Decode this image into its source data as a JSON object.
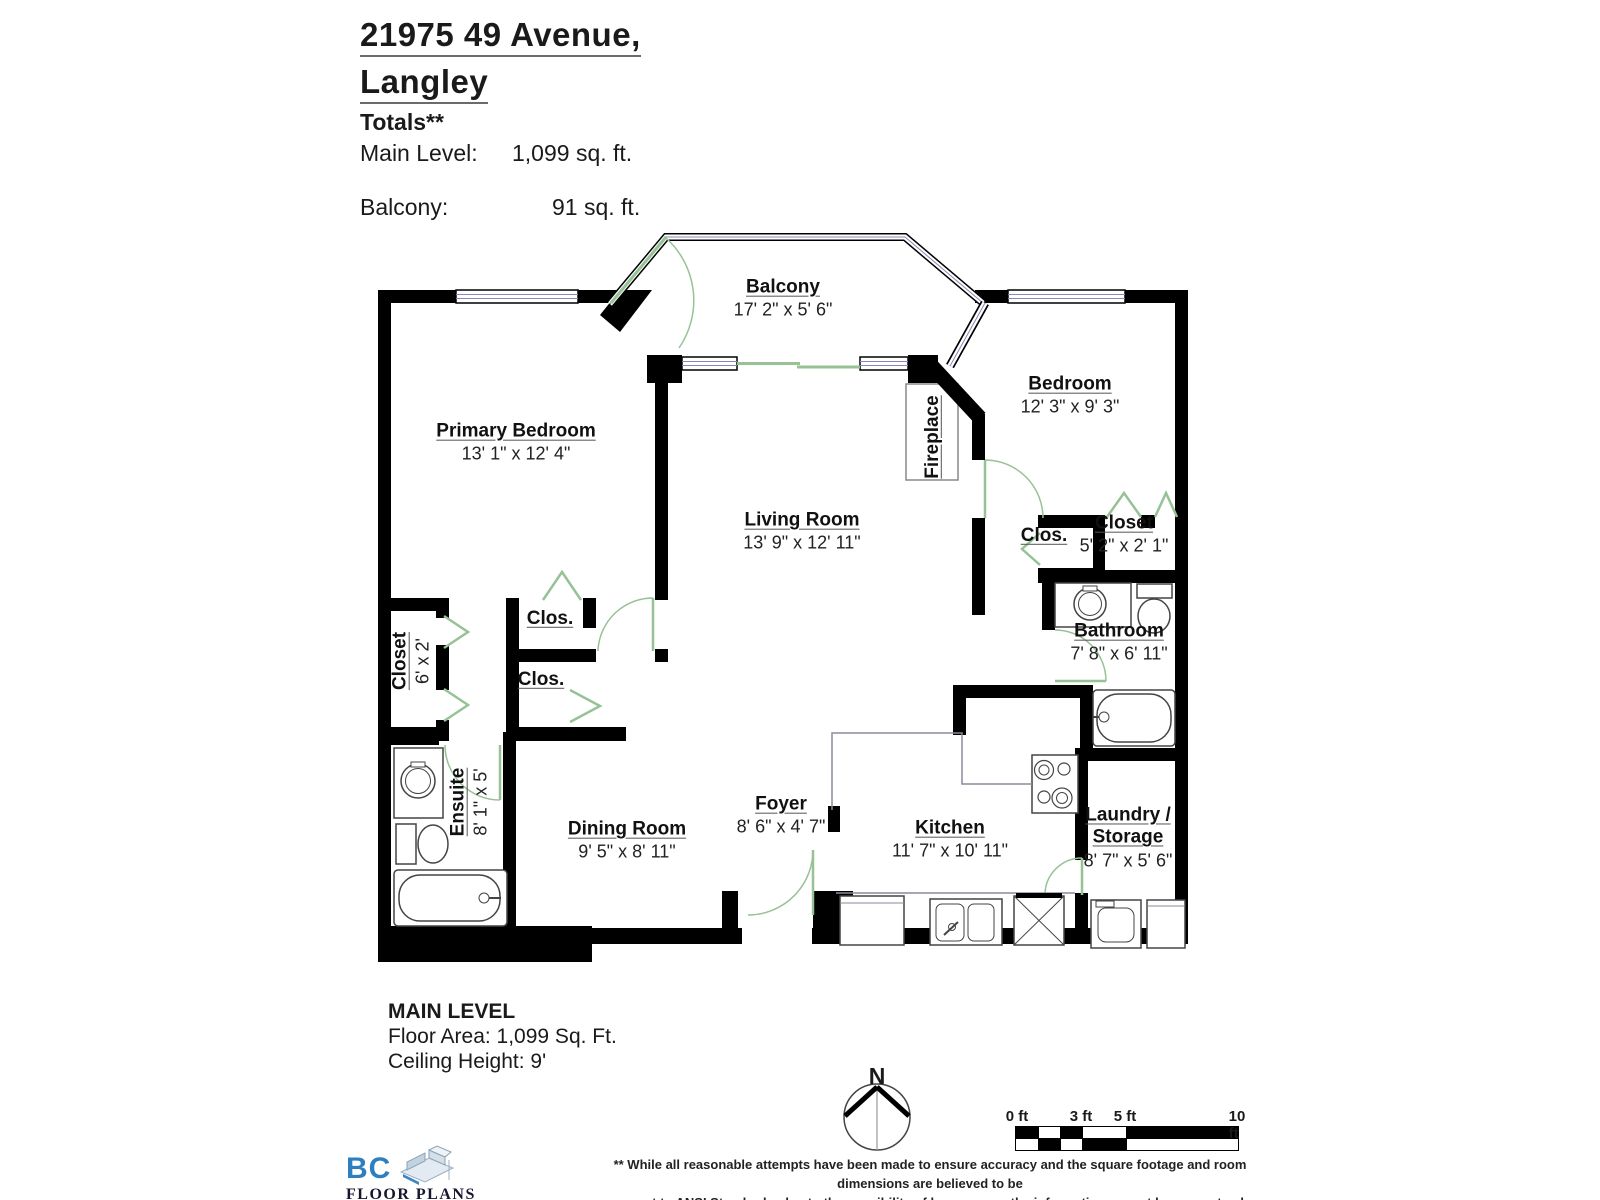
{
  "header": {
    "title_line1": "21975 49 Avenue,",
    "title_line2": "Langley",
    "totals_label": "Totals**",
    "totals": [
      {
        "label": "Main Level:",
        "value": "1,099 sq. ft."
      },
      {
        "label": "Balcony:",
        "value": "91 sq. ft."
      }
    ]
  },
  "rooms": {
    "balcony": {
      "name": "Balcony",
      "dims": "17' 2\" x 5' 6\""
    },
    "primary_bedroom": {
      "name": "Primary Bedroom",
      "dims": "13' 1\" x 12' 4\""
    },
    "bedroom": {
      "name": "Bedroom",
      "dims": "12' 3\" x 9' 3\""
    },
    "living_room": {
      "name": "Living Room",
      "dims": "13' 9\" x 12' 11\""
    },
    "fireplace": {
      "name": "Fireplace"
    },
    "closet_small_1": {
      "name": "Clos."
    },
    "closet_small_2": {
      "name": "Clos."
    },
    "closet_small_3": {
      "name": "Clos."
    },
    "closet_left": {
      "name": "Closet",
      "dims": "6' x 2'"
    },
    "ensuite": {
      "name": "Ensuite",
      "dims": "8' 1\" x 5'"
    },
    "closet_right": {
      "name": "Closet",
      "dims": "5' 2\" x 2' 1\""
    },
    "bathroom": {
      "name": "Bathroom",
      "dims": "7' 8\" x 6' 11\""
    },
    "dining_room": {
      "name": "Dining Room",
      "dims": "9' 5\" x 8' 11\""
    },
    "foyer": {
      "name": "Foyer",
      "dims": "8' 6\" x 4' 7\""
    },
    "kitchen": {
      "name": "Kitchen",
      "dims": "11' 7\" x 10' 11\""
    },
    "laundry": {
      "name_line1": "Laundry /",
      "name_line2": "Storage",
      "dims": "8' 7\" x 5' 6\""
    }
  },
  "footer": {
    "level_name": "MAIN LEVEL",
    "floor_area": "Floor Area: 1,099 Sq. Ft.",
    "ceiling_height": "Ceiling Height: 9'",
    "compass_label": "N",
    "scale": {
      "labels": [
        "0 ft",
        "3 ft",
        "5 ft",
        "10 ft"
      ]
    },
    "logo": {
      "line1": "BC",
      "line2": "FLOOR PLANS"
    },
    "disclaimer_line1": "** While all reasonable attempts have been made to ensure accuracy and the square footage and room dimensions are believed to be",
    "disclaimer_line2": "correct to ANSI Standards, due to the possibility of human error the information cannot be guaranteed. E&O Insured for $1,000,000"
  },
  "colors": {
    "wall": "#000000",
    "door": "#96c296",
    "window": "#8787b8",
    "counter": "#8a8a9d",
    "logo_blue": "#2e7fc0"
  }
}
